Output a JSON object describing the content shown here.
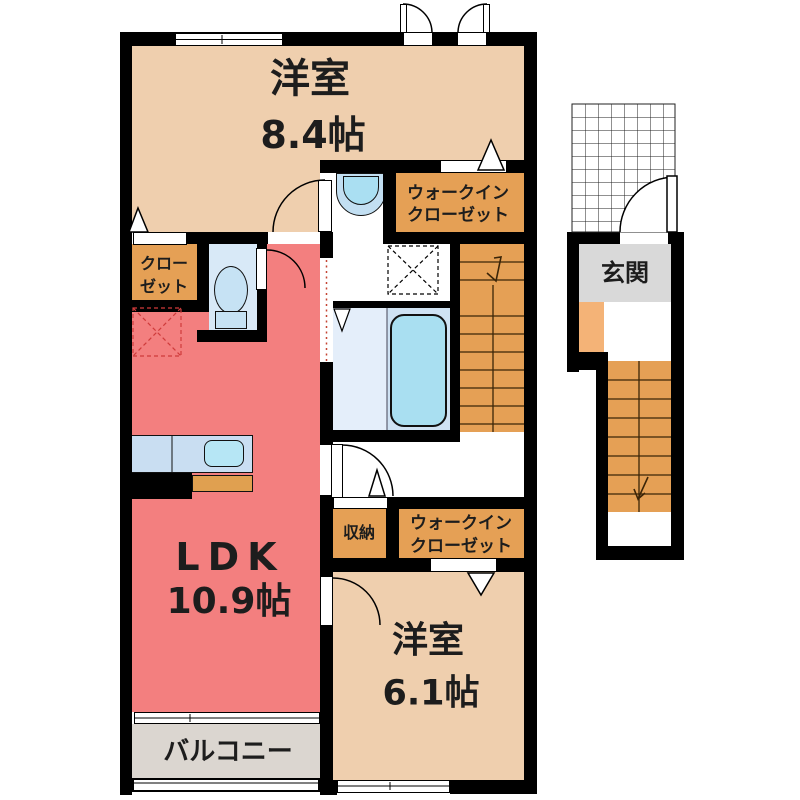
{
  "plan": {
    "rooms": {
      "bedroom_top": {
        "name": "洋室",
        "area": "8.4帖"
      },
      "wic_top": {
        "line1": "ウォークイン",
        "line2": "クローゼット"
      },
      "closet": {
        "line1": "クロー",
        "line2": "ゼット"
      },
      "ldk": {
        "name": "LDK",
        "area": "10.9帖"
      },
      "storage": {
        "name": "収納"
      },
      "wic_bottom": {
        "line1": "ウォークイン",
        "line2": "クローゼット"
      },
      "bedroom_bottom": {
        "name": "洋室",
        "area": "6.1帖"
      },
      "balcony": {
        "name": "バルコニー"
      },
      "entrance": {
        "name": "玄関"
      }
    },
    "fixtures": {
      "toilet": "toilet-icon (ellipse bowl + tank)",
      "bathtub": "bathtub-icon (rounded rect)",
      "washbasin": "washbasin-icon (half-round bowl)",
      "kitchen_sink": "kitchen-sink-icon (rounded rect in counter)",
      "interior_stairs": "stairs-icon (treads + direction arrow)",
      "entrance_stairs": "stairs-icon (treads + direction arrow)",
      "porch_grid": "hatched-grid",
      "inspection_hatch": "dashed-x-square"
    },
    "colors": {
      "wall": "#000000",
      "bedroom_peach": "#efcfae",
      "ldk_salmon": "#f37f7f",
      "closet_orange": "#e5a055",
      "entrance_step_orange": "#f4b377",
      "entrance_floor_gray": "#d9d9d9",
      "balcony_gray": "#dbd6d0",
      "water_room_blue": "#d8e9f7",
      "bathtub_blue": "#a9dff1",
      "counter_blue": "#c9def2"
    }
  }
}
